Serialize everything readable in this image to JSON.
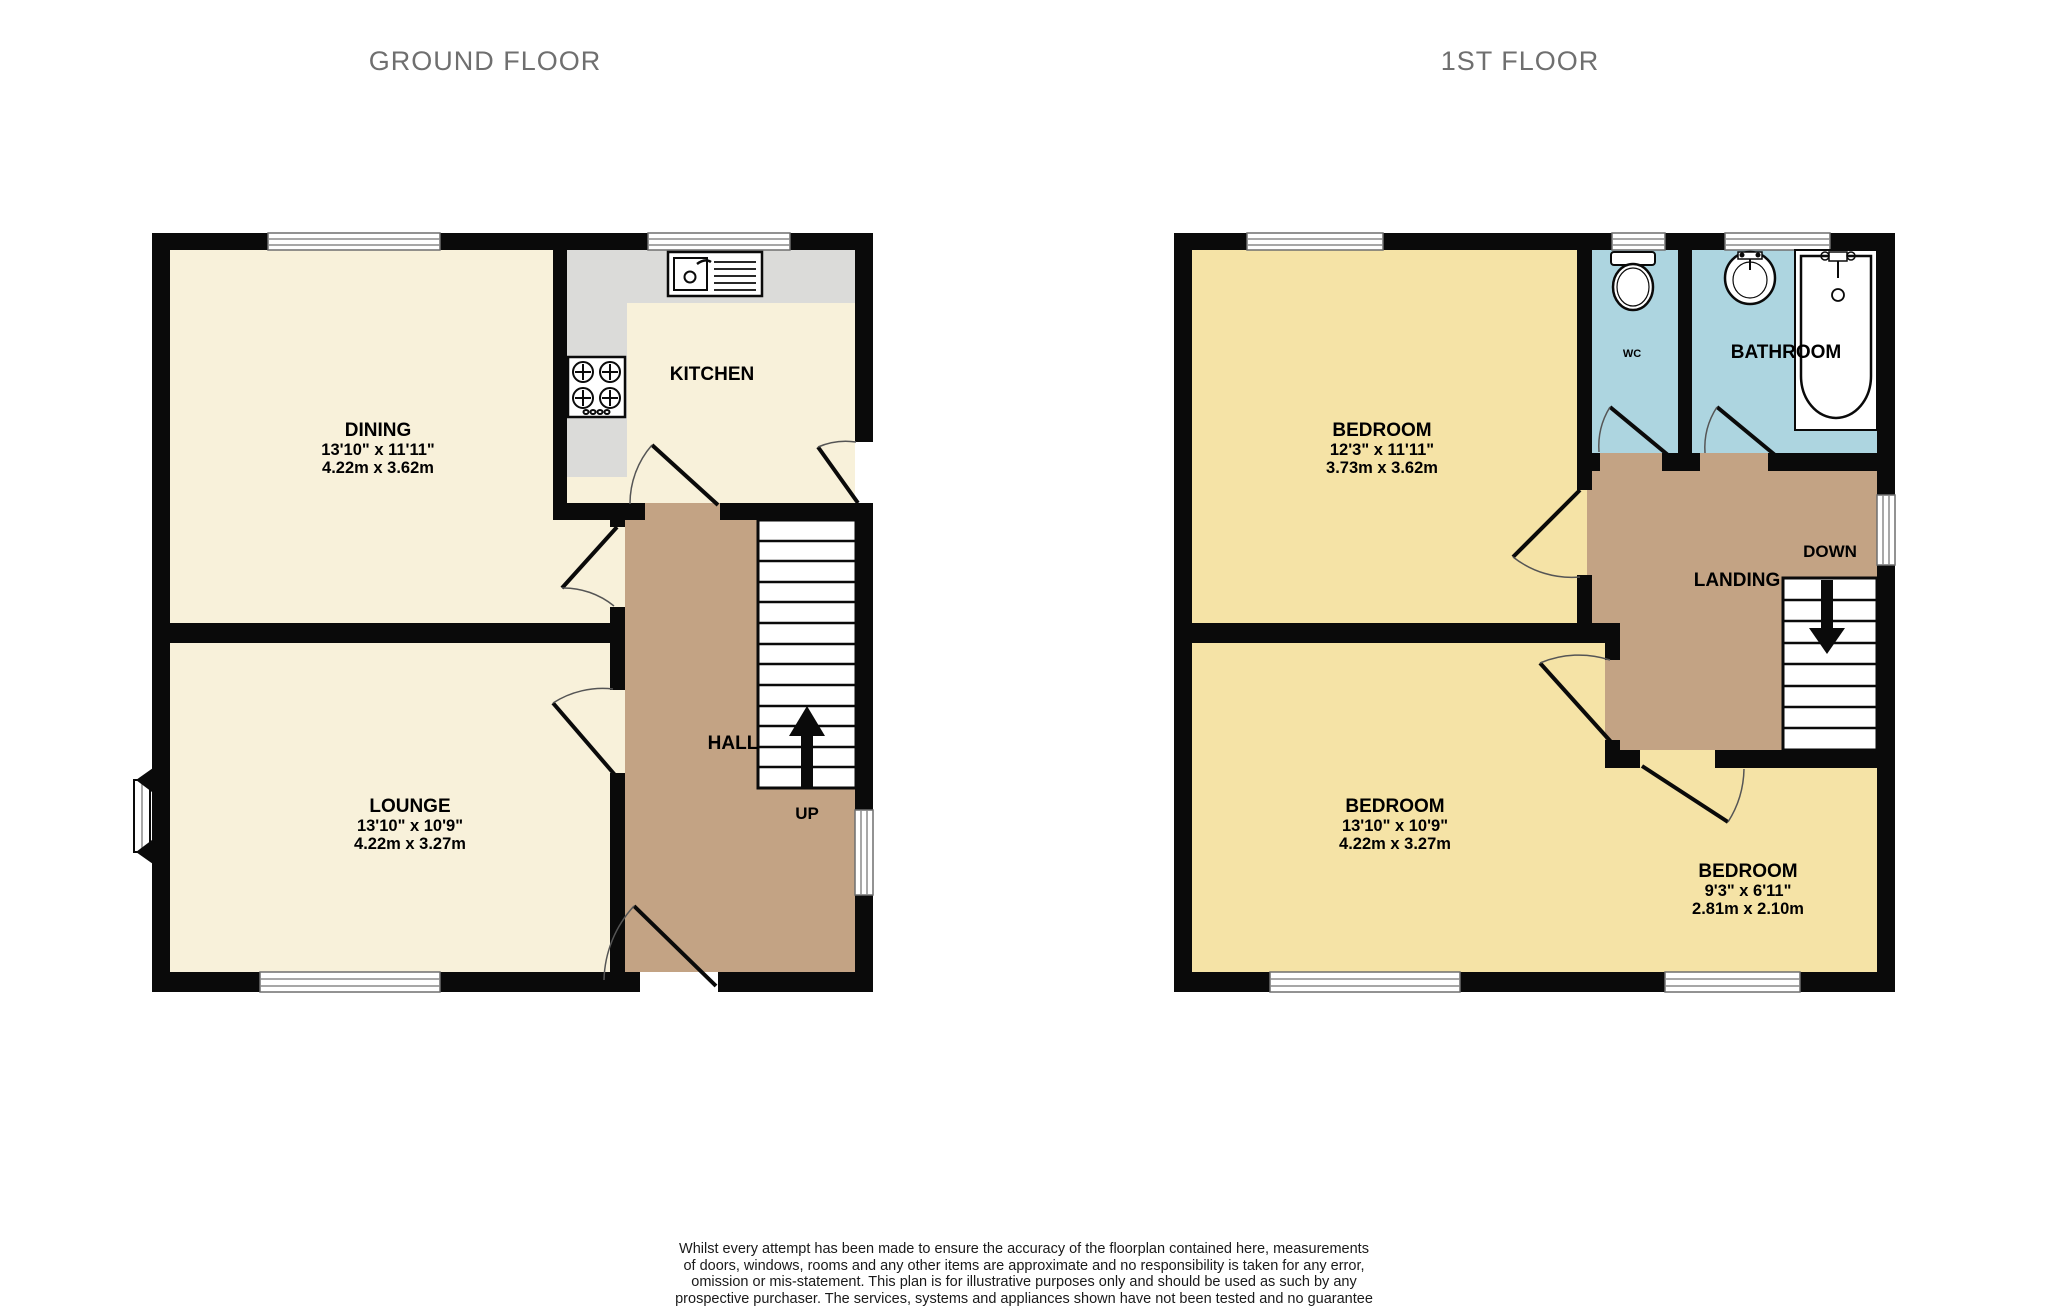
{
  "titles": {
    "ground": "GROUND FLOOR",
    "first": "1ST FLOOR"
  },
  "ground_floor": {
    "rooms": {
      "dining": {
        "name": "DINING",
        "imperial": "13'10\" x 11'11\"",
        "metric": "4.22m x 3.62m"
      },
      "kitchen": {
        "name": "KITCHEN"
      },
      "lounge": {
        "name": "LOUNGE",
        "imperial": "13'10\" x 10'9\"",
        "metric": "4.22m x 3.27m"
      },
      "hall": {
        "name": "HALL",
        "stairs_label": "UP"
      }
    }
  },
  "first_floor": {
    "rooms": {
      "bedroom1": {
        "name": "BEDROOM",
        "imperial": "12'3\" x 11'11\"",
        "metric": "3.73m x 3.62m"
      },
      "bedroom2": {
        "name": "BEDROOM",
        "imperial": "13'10\" x 10'9\"",
        "metric": "4.22m x 3.27m"
      },
      "bedroom3": {
        "name": "BEDROOM",
        "imperial": "9'3\" x 6'11\"",
        "metric": "2.81m x 2.10m"
      },
      "wc": {
        "name": "WC"
      },
      "bathroom": {
        "name": "BATHROOM"
      },
      "landing": {
        "name": "LANDING",
        "stairs_label": "DOWN"
      }
    }
  },
  "disclaimer": {
    "lines": [
      "Whilst every attempt has been made to ensure the accuracy of the floorplan contained here, measurements",
      "of doors, windows, rooms and any other items are approximate and no responsibility is taken for any error,",
      "omission or mis-statement. This plan is for illustrative purposes only and should be used as such by any",
      "prospective purchaser. The services, systems and appliances shown have not been tested and no guarantee",
      "as to their operability or efficiency can be given.",
      "Made with Metropix ©2025"
    ]
  },
  "colors": {
    "wall": "#0a0a0a",
    "room_cream": "#f8f1da",
    "room_yellow": "#f5e3a6",
    "hall_tan": "#c3a384",
    "bath_blue": "#add5e0",
    "counter_gray": "#dbdbd9",
    "window_line": "#8a8a8a",
    "title_gray": "#6f6f6f"
  }
}
